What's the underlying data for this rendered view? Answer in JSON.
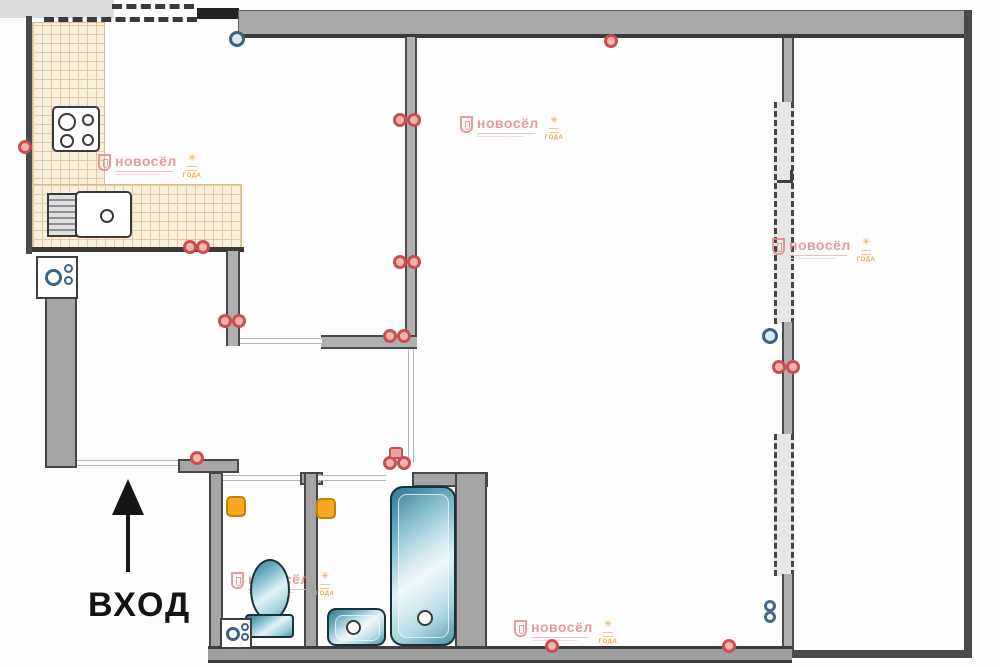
{
  "title": "apartment-floor-plan",
  "entrance": {
    "label": "ВХОД"
  },
  "watermark": {
    "brand": "новосёл",
    "badge": "ГОДА"
  },
  "watermark_positions": [
    {
      "x": 98,
      "y": 154
    },
    {
      "x": 460,
      "y": 116
    },
    {
      "x": 772,
      "y": 238
    },
    {
      "x": 231,
      "y": 572
    },
    {
      "x": 514,
      "y": 620
    }
  ],
  "markers": {
    "outlets": [
      {
        "x": 18,
        "y": 140
      },
      {
        "x": 183,
        "y": 240
      },
      {
        "x": 196,
        "y": 240
      },
      {
        "x": 393,
        "y": 113
      },
      {
        "x": 407,
        "y": 113
      },
      {
        "x": 393,
        "y": 255
      },
      {
        "x": 407,
        "y": 255
      },
      {
        "x": 604,
        "y": 34
      },
      {
        "x": 218,
        "y": 314
      },
      {
        "x": 232,
        "y": 314
      },
      {
        "x": 383,
        "y": 329
      },
      {
        "x": 397,
        "y": 329
      },
      {
        "x": 772,
        "y": 360
      },
      {
        "x": 786,
        "y": 360
      },
      {
        "x": 190,
        "y": 451
      },
      {
        "x": 383,
        "y": 456
      },
      {
        "x": 397,
        "y": 456
      },
      {
        "x": 545,
        "y": 639
      },
      {
        "x": 722,
        "y": 639
      }
    ],
    "outlet_blocks": [
      {
        "x": 389,
        "y": 447
      }
    ],
    "risers": [
      {
        "x": 229,
        "y": 31
      },
      {
        "x": 762,
        "y": 328
      }
    ],
    "riser_eights": [
      {
        "x": 764,
        "y": 600
      },
      {
        "x": 764,
        "y": 611
      }
    ]
  }
}
